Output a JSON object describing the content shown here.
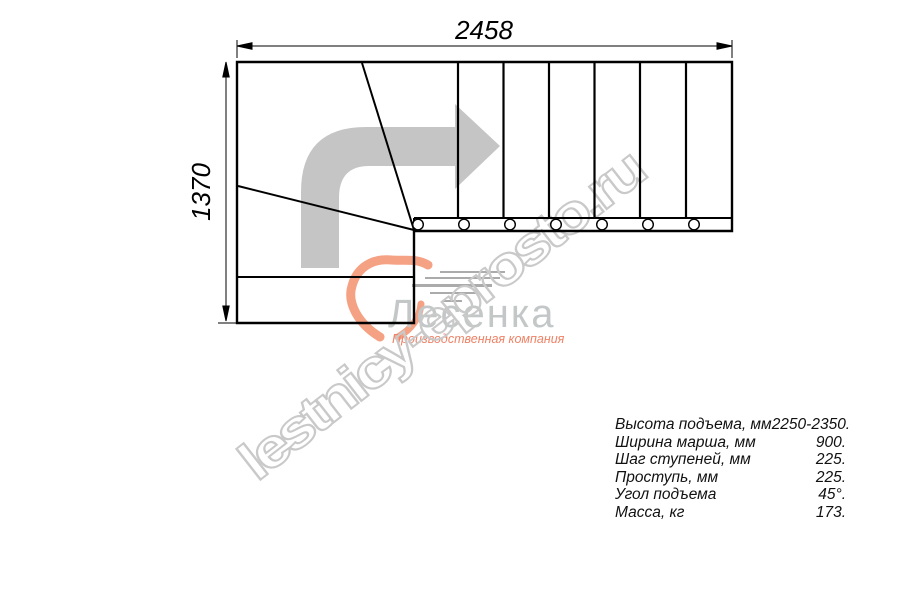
{
  "drawing": {
    "width_label": "2458",
    "height_label": "1370",
    "steps_x": [
      458,
      503.5,
      549,
      594.5,
      640,
      686
    ],
    "baluster_x": [
      418,
      464,
      510,
      556,
      602,
      648,
      694
    ],
    "line_color": "#000000",
    "arrow_color": "#c5c5c5"
  },
  "watermark": {
    "text": "lestnicy-eprosto.ru",
    "color": "#c9c9c9"
  },
  "logo": {
    "company": "Лесенка",
    "tagline": "Производственная компания",
    "accent_color": "#f5a183",
    "tagline_color": "#ee8266",
    "text_color": "#c3c7c8",
    "speedline_color": "#ababab"
  },
  "specs": {
    "rows": [
      {
        "label": "Высота подъема, мм",
        "value": "2250-2350."
      },
      {
        "label": "Ширина марша, мм",
        "value": "900."
      },
      {
        "label": "Шаг ступеней, мм",
        "value": "225."
      },
      {
        "label": "Проступь, мм",
        "value": "225."
      },
      {
        "label": "Угол подъема",
        "value": "45°."
      },
      {
        "label": "Масса, кг",
        "value": "173."
      }
    ]
  }
}
